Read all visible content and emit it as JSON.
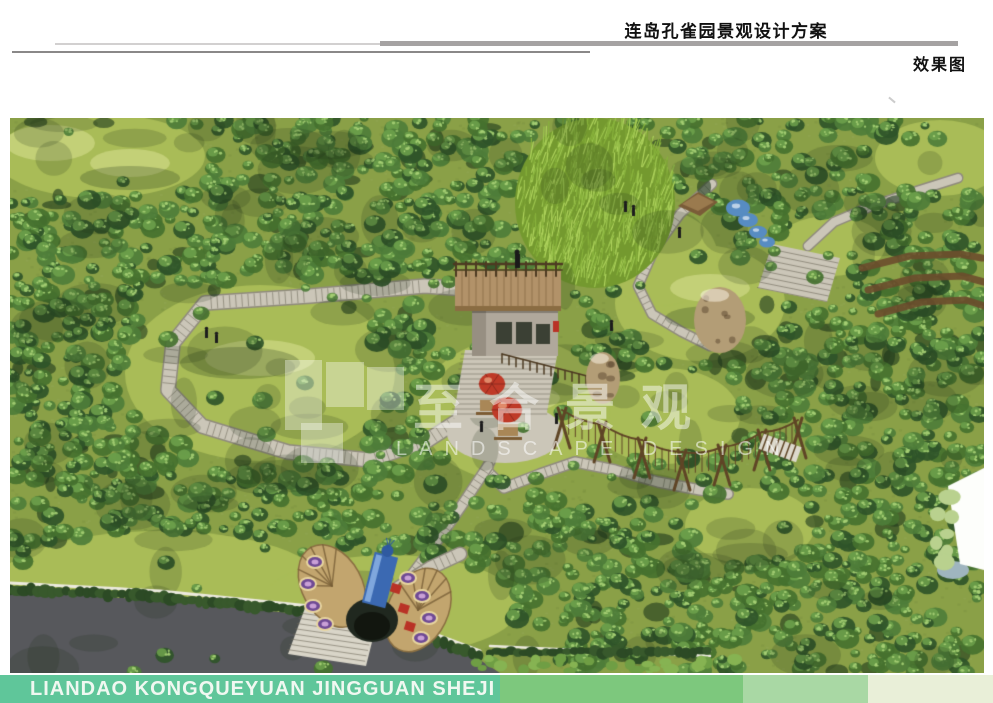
{
  "header": {
    "title": "连岛孔雀园景观设计方案",
    "subtitle": "效果图"
  },
  "footer": {
    "text": "LIANDAO KONGQUEYUAN JINGGUAN SHEJI FANGAN",
    "segments": [
      "#5fc69a",
      "#7dc87d",
      "#a9d8a4",
      "#e9efd8"
    ]
  },
  "watermark": {
    "cn": "至合景观",
    "en": "LANDSCAPE DESIGN"
  },
  "scene": {
    "label": "aerial-3d-landscape-render",
    "colors": {
      "grass": "#8aa047",
      "lawn": "#a9bc57",
      "lawn_light": "#c9d47f",
      "canopy_dark": "#2f5429",
      "canopy_mid": "#4e7d39",
      "canopy_mid2": "#45712f",
      "canopy_light": "#6fa24c",
      "canopy_highlight": "#a6cf74",
      "bamboo_base": "#74992f",
      "bamboo": "#9cc44e",
      "bamboo_light": "#aed25c",
      "path": "#cbc6b8",
      "path_edge": "#8f8a7d",
      "road": "#57585c",
      "hedge": "#2c4a25",
      "curb": "#eceadf",
      "wood": "#5f4526",
      "deck_wood": "#b29269",
      "stone_base": "#b0a89b",
      "umbrella": "#bf3a28",
      "peacock_blue": "#3b69b2",
      "peacock_fan": "#c2a56e",
      "feather_eye": "#6f4a94",
      "accent_red": "#b93226",
      "water": "#578cc2",
      "rock": "#b39d76",
      "white": "#fdfefb"
    }
  }
}
